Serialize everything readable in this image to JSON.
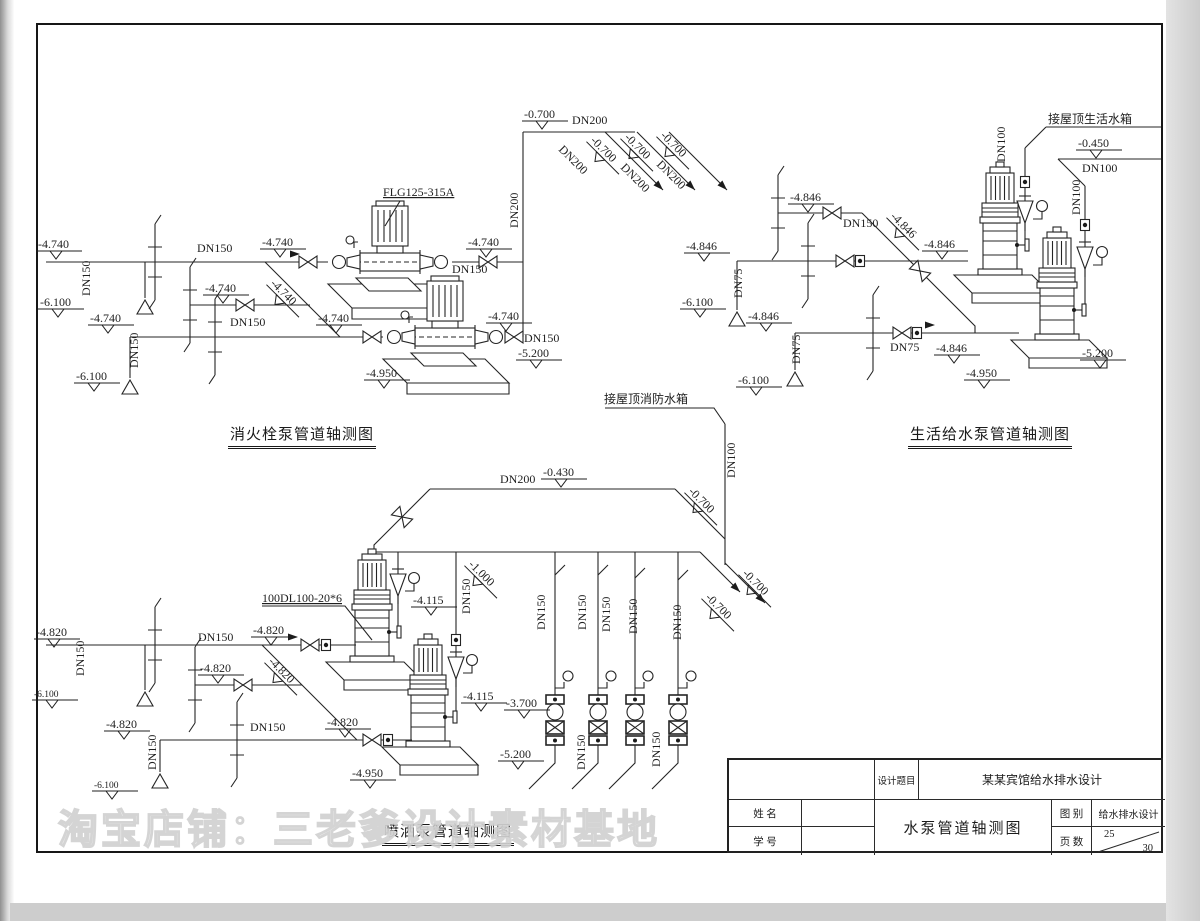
{
  "page": {
    "watermark": "淘宝店铺：三老爹设计素材基地"
  },
  "diagrams": {
    "fire": {
      "title": "消火栓泵管道轴测图"
    },
    "domestic": {
      "title": "生活给水泵管道轴测图"
    },
    "spray": {
      "title": "喷洒泵管道轴测图"
    }
  },
  "title_block": {
    "design_title_label": "设计题目",
    "design_title_value": "某某宾馆给水排水设计",
    "name_label": "姓  名",
    "student_id_label": "学  号",
    "drawing_title": "水泵管道轴测图",
    "category_label": "图  别",
    "category_value": "给水排水设计",
    "pages_label": "页  数",
    "page_number": "25",
    "page_total": "30"
  },
  "annotations": [
    {
      "t": "-4.740",
      "x": 38,
      "y": 248,
      "m": 1
    },
    {
      "t": "DN150",
      "x": 197,
      "y": 252
    },
    {
      "t": "-4.740",
      "x": 262,
      "y": 246,
      "m": 1
    },
    {
      "t": "-4.740",
      "x": 468,
      "y": 246,
      "m": 1
    },
    {
      "t": "DN150",
      "x": 90,
      "y": 296,
      "r": -90
    },
    {
      "t": "-6.100",
      "x": 40,
      "y": 306,
      "m": 1
    },
    {
      "t": "-4.740",
      "x": 90,
      "y": 322,
      "m": 1
    },
    {
      "t": "-4.740",
      "x": 205,
      "y": 292,
      "m": 1
    },
    {
      "t": "-4.740",
      "x": 270,
      "y": 284,
      "r": 45,
      "m": 1
    },
    {
      "t": "DN150",
      "x": 230,
      "y": 326
    },
    {
      "t": "-4.740",
      "x": 318,
      "y": 322,
      "m": 1
    },
    {
      "t": "DN150",
      "x": 138,
      "y": 368,
      "r": -90
    },
    {
      "t": "-6.100",
      "x": 76,
      "y": 380,
      "m": 1
    },
    {
      "t": "FLG125-315A",
      "x": 383,
      "y": 196,
      "u": 1,
      "n": "pump-model-label"
    },
    {
      "t": "-4.740",
      "x": 488,
      "y": 320,
      "m": 1
    },
    {
      "t": "DN150",
      "x": 452,
      "y": 273
    },
    {
      "t": "DN150",
      "x": 524,
      "y": 342
    },
    {
      "t": "-5.200",
      "x": 518,
      "y": 357,
      "m": 1
    },
    {
      "t": "-4.950",
      "x": 366,
      "y": 377,
      "m": 1
    },
    {
      "t": "-0.700",
      "x": 524,
      "y": 118,
      "m": 1
    },
    {
      "t": "DN200",
      "x": 572,
      "y": 124
    },
    {
      "t": "DN200",
      "x": 558,
      "y": 150,
      "r": 45
    },
    {
      "t": "-0.700",
      "x": 590,
      "y": 141,
      "r": 45,
      "m": 1
    },
    {
      "t": "DN200",
      "x": 620,
      "y": 168,
      "r": 45
    },
    {
      "t": "-0.700",
      "x": 624,
      "y": 138,
      "r": 45,
      "m": 1
    },
    {
      "t": "DN200",
      "x": 656,
      "y": 165,
      "r": 45
    },
    {
      "t": "-0.700",
      "x": 660,
      "y": 136,
      "r": 45,
      "m": 1
    },
    {
      "t": "DN200",
      "x": 518,
      "y": 228,
      "r": -90
    },
    {
      "t": "接屋顶生活水箱",
      "x": 1048,
      "y": 123,
      "n": "tank-label"
    },
    {
      "t": "-0.450",
      "x": 1078,
      "y": 147,
      "m": 1
    },
    {
      "t": "DN100",
      "x": 1082,
      "y": 172
    },
    {
      "t": "DN100",
      "x": 1005,
      "y": 162,
      "r": -90
    },
    {
      "t": "DN100",
      "x": 1080,
      "y": 215,
      "r": -90
    },
    {
      "t": "-4.846",
      "x": 790,
      "y": 201,
      "m": 1
    },
    {
      "t": "DN150",
      "x": 843,
      "y": 227
    },
    {
      "t": "-4.846",
      "x": 890,
      "y": 217,
      "r": 45,
      "m": 1
    },
    {
      "t": "-4.846",
      "x": 924,
      "y": 248,
      "m": 1
    },
    {
      "t": "-4.846",
      "x": 686,
      "y": 250,
      "m": 1
    },
    {
      "t": "DN75",
      "x": 742,
      "y": 298,
      "r": -90
    },
    {
      "t": "-6.100",
      "x": 682,
      "y": 306,
      "m": 1
    },
    {
      "t": "-4.846",
      "x": 748,
      "y": 320,
      "m": 1
    },
    {
      "t": "DN75",
      "x": 800,
      "y": 364,
      "r": -90
    },
    {
      "t": "-6.100",
      "x": 738,
      "y": 384,
      "m": 1
    },
    {
      "t": "DN75",
      "x": 890,
      "y": 351
    },
    {
      "t": "-4.846",
      "x": 936,
      "y": 352,
      "m": 1
    },
    {
      "t": "-4.950",
      "x": 966,
      "y": 377,
      "m": 1
    },
    {
      "t": "-5.200",
      "x": 1082,
      "y": 357,
      "m": 1
    },
    {
      "t": "接屋顶消防水箱",
      "x": 604,
      "y": 403,
      "n": "tank-label"
    },
    {
      "t": "DN200",
      "x": 500,
      "y": 483
    },
    {
      "t": "-0.430",
      "x": 543,
      "y": 476,
      "m": 1
    },
    {
      "t": "DN100",
      "x": 735,
      "y": 478,
      "r": -90
    },
    {
      "t": "-0.700",
      "x": 688,
      "y": 492,
      "r": 45,
      "m": 1
    },
    {
      "t": "-1.000",
      "x": 468,
      "y": 565,
      "r": 45,
      "m": 1
    },
    {
      "t": "-0.700",
      "x": 705,
      "y": 598,
      "r": 45,
      "m": 1
    },
    {
      "t": "-0.700",
      "x": 742,
      "y": 574,
      "r": 45,
      "m": 1
    },
    {
      "t": "DN150",
      "x": 545,
      "y": 630,
      "r": -90
    },
    {
      "t": "DN150",
      "x": 586,
      "y": 630,
      "r": -90
    },
    {
      "t": "DN150",
      "x": 610,
      "y": 632,
      "r": -90
    },
    {
      "t": "DN150",
      "x": 637,
      "y": 634,
      "r": -90
    },
    {
      "t": "DN150",
      "x": 681,
      "y": 640,
      "r": -90
    },
    {
      "t": "DN150",
      "x": 585,
      "y": 770,
      "r": -90
    },
    {
      "t": "DN150",
      "x": 660,
      "y": 767,
      "r": -90
    },
    {
      "t": "DN150",
      "x": 470,
      "y": 614,
      "r": -90
    },
    {
      "t": "100DL100-20*6",
      "x": 262,
      "y": 602,
      "u": 1,
      "n": "pump-model-label"
    },
    {
      "t": "-4.820",
      "x": 36,
      "y": 636,
      "m": 1
    },
    {
      "t": "DN150",
      "x": 198,
      "y": 641
    },
    {
      "t": "-4.820",
      "x": 253,
      "y": 634,
      "m": 1
    },
    {
      "t": "DN150",
      "x": 84,
      "y": 676,
      "r": -90
    },
    {
      "t": "-6.100",
      "x": 34,
      "y": 697,
      "m": 1,
      "s": 1
    },
    {
      "t": "-4.820",
      "x": 200,
      "y": 672,
      "m": 1
    },
    {
      "t": "-4.820",
      "x": 268,
      "y": 662,
      "r": 45,
      "m": 1
    },
    {
      "t": "-4.820",
      "x": 106,
      "y": 728,
      "m": 1
    },
    {
      "t": "DN150",
      "x": 250,
      "y": 731
    },
    {
      "t": "DN150",
      "x": 156,
      "y": 770,
      "r": -90
    },
    {
      "t": "-6.100",
      "x": 94,
      "y": 788,
      "m": 1,
      "s": 1
    },
    {
      "t": "-4.820",
      "x": 327,
      "y": 726,
      "m": 1
    },
    {
      "t": "-4.115",
      "x": 413,
      "y": 604,
      "m": 1
    },
    {
      "t": "-4.115",
      "x": 463,
      "y": 700,
      "m": 1
    },
    {
      "t": "-3.700",
      "x": 506,
      "y": 707,
      "m": 1
    },
    {
      "t": "-5.200",
      "x": 500,
      "y": 758,
      "m": 1
    },
    {
      "t": "-4.950",
      "x": 352,
      "y": 777,
      "m": 1
    }
  ]
}
